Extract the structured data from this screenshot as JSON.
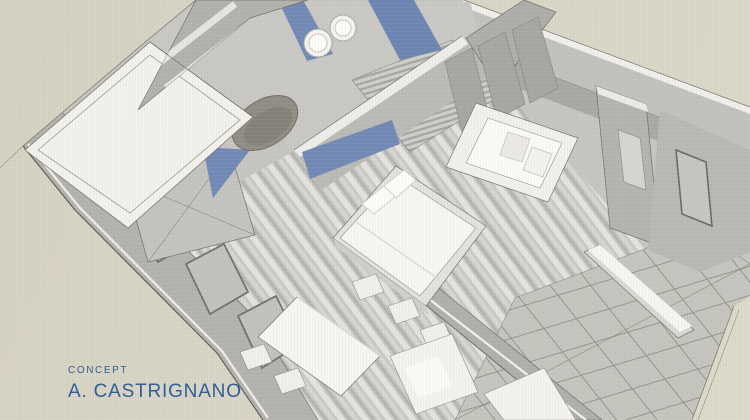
{
  "page": {
    "background_color": "#d8d4c5",
    "accent_blue": "#7189b4",
    "caption_color": "#2d5f98",
    "wall_gray": "#b5b4b0",
    "floor_gray": "#c6c5c1",
    "furniture_white": "#f6f5f1"
  },
  "caption": {
    "label": "CONCEPT",
    "author": "A. CASTRIGNANO"
  },
  "scene": {
    "type": "3d-concept-render",
    "description": "Aerial cutaway concept rendering of a studio apartment interior on beige paper",
    "rooms": [
      "kitchen",
      "bathroom",
      "bedroom",
      "living-area",
      "entry-hall",
      "tiled-terrace"
    ],
    "visible_objects": [
      "white counter slab",
      "oval basin sink",
      "two round hobs",
      "blue glass panels",
      "slatted cabinet",
      "x-braced panel",
      "double bed with pillows",
      "blue headboard band",
      "wardrobe panels",
      "white sofa with cushions",
      "entry partition with shelf",
      "dining table with chairs",
      "terrace bench",
      "plank flooring",
      "tile grid flooring"
    ]
  }
}
